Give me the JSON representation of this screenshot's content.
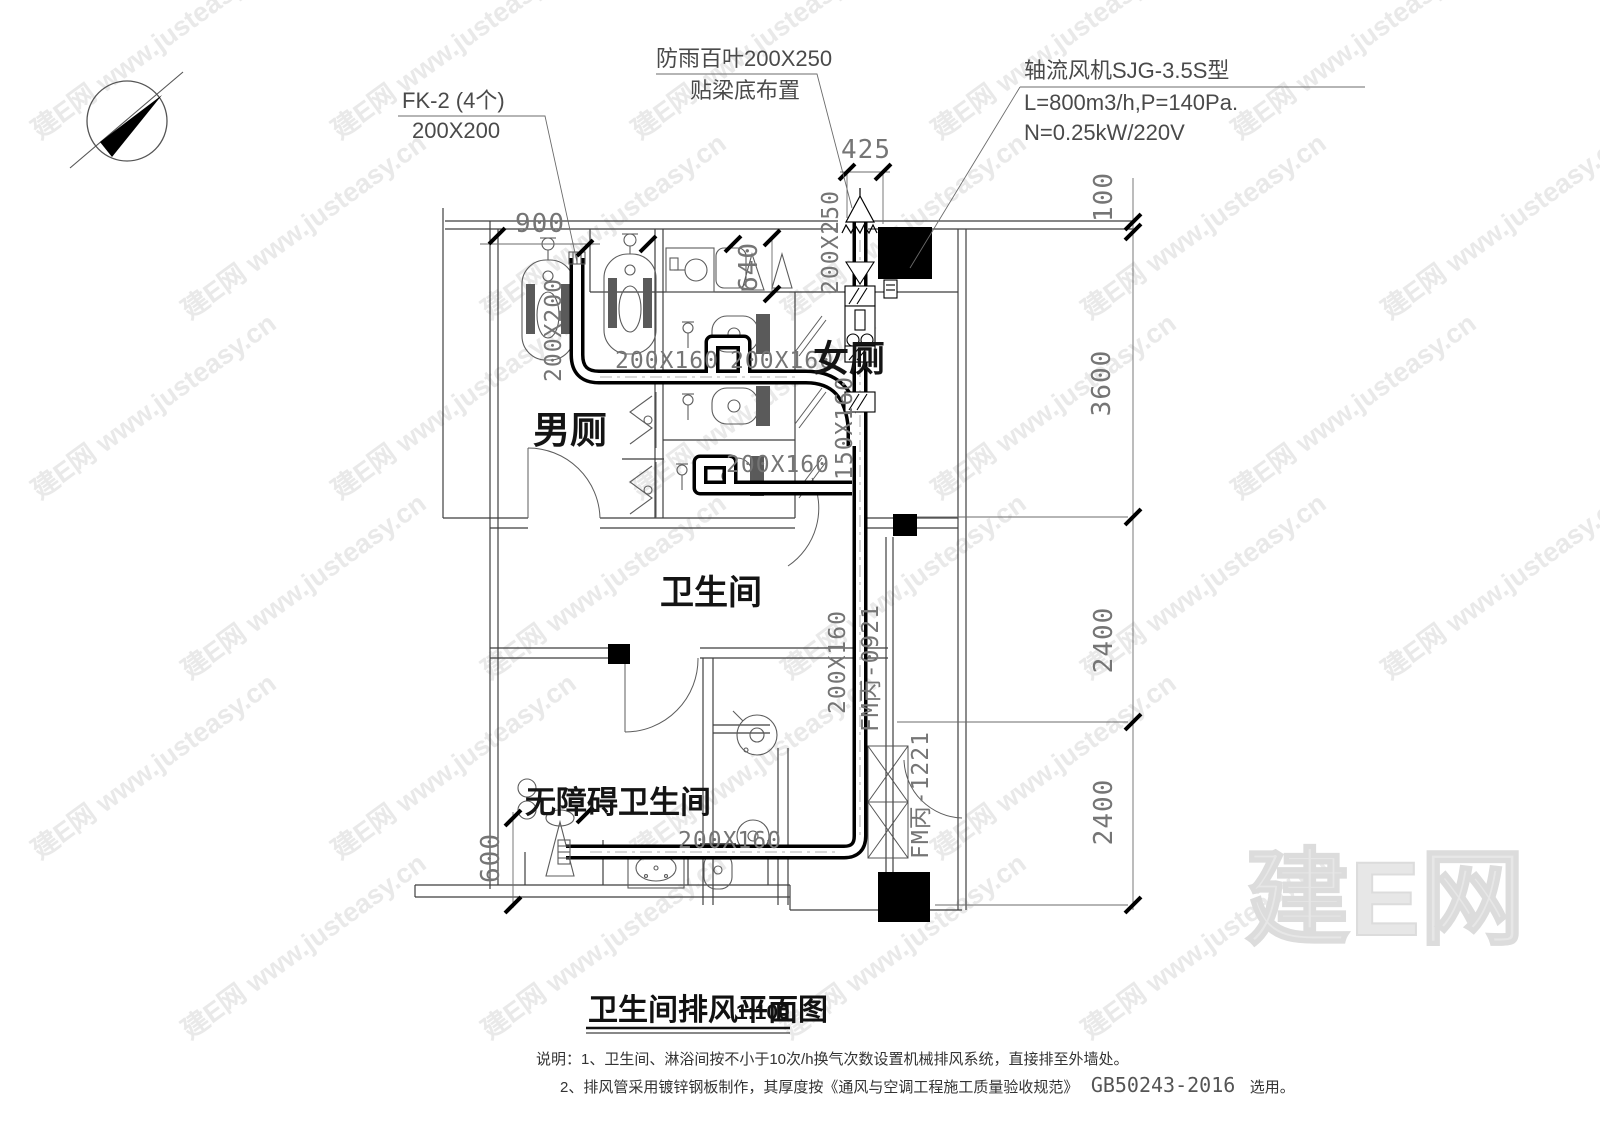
{
  "colors": {
    "line": "#3f3f3f",
    "duct": "#000000",
    "dim_text": "#757575",
    "watermark": "#e9e9e9"
  },
  "annotations": {
    "fk2_1": "FK-2 (4个)",
    "fk2_2": "200X200",
    "louver_1": "防雨百叶200X250",
    "louver_2": "贴梁底布置",
    "fan_1": "轴流风机SJG-3.5S型",
    "fan_2": "L=800m3/h,P=140Pa.",
    "fan_3": "N=0.25kW/220V"
  },
  "rooms": {
    "male": "男厕",
    "female": "女厕",
    "bathroom": "卫生间",
    "accessible": "无障碍卫生间"
  },
  "dims": {
    "d900": "900",
    "d425": "425",
    "d100": "100",
    "d3600": "3600",
    "d2400": "2400",
    "d600": "600",
    "d640": "640"
  },
  "ducts": {
    "size_200x160": "200X160",
    "size_150x160": "150X160",
    "size_200x250": "200X250",
    "size_200x200": "200X200",
    "fm_0921": "FM丙-0921",
    "fm_1221": "FM丙-1221"
  },
  "title": {
    "text": "卫生间排风平面图",
    "scale": "1:100"
  },
  "notes": {
    "line1": "说明：1、卫生间、淋浴间按不小于10次/h换气次数设置机械排风系统，直接排至外墙处。",
    "line2_pre": "2、排风管采用镀锌钢板制作，其厚度按《通风与空调工程施工质量验收规范》",
    "line2_code": "GB50243-2016",
    "line2_post": "选用。"
  },
  "watermark": {
    "tile": "建E网 www.justeasy.cn",
    "big": "建E网"
  }
}
